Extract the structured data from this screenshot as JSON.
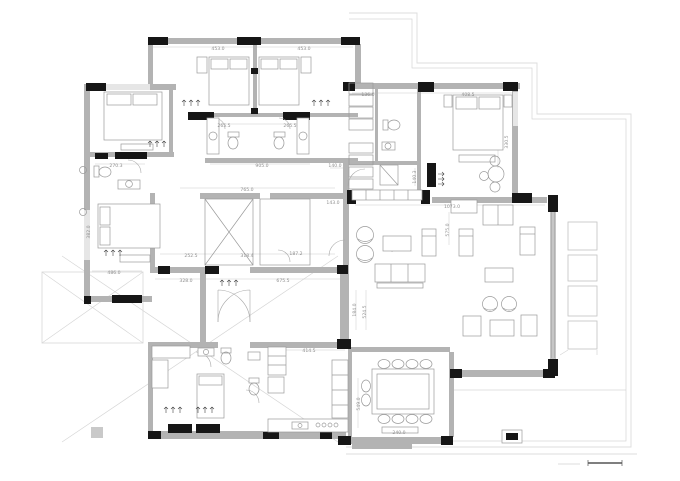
{
  "drawing": {
    "type": "architectural-floor-plan",
    "description": "Single-storey house plan with bedrooms, bathrooms, living room, dining room, kitchen, carport and terrace"
  },
  "colors": {
    "wall_gray": "#b3b3b3",
    "column_black": "#161616",
    "furniture_line": "#9a9a9a",
    "boundary_light": "#dcdcdc",
    "dimension_text": "#8f8f8f",
    "background": "#ffffff"
  },
  "symbols": [
    "double-bed-icon",
    "single-bed-icon",
    "toilet-icon",
    "sink-icon",
    "shower-icon",
    "dining-table-icon",
    "chair-icon",
    "sofa-icon",
    "armchair-icon",
    "coffee-table-icon",
    "kitchen-counter-icon",
    "wardrobe-icon",
    "stair-cross-icon",
    "door-swing-icon",
    "lounger-icon",
    "scale-bar-icon",
    "grid-marker-icon"
  ],
  "dims": [
    {
      "text": "453.0"
    },
    {
      "text": "453.0"
    },
    {
      "text": "136.0"
    },
    {
      "text": "408.5"
    },
    {
      "text": "265.5"
    },
    {
      "text": "265.5"
    },
    {
      "text": "905.0"
    },
    {
      "text": "765.0"
    },
    {
      "text": "140.0"
    },
    {
      "text": "143.0"
    },
    {
      "text": "140.3"
    },
    {
      "text": "270.3"
    },
    {
      "text": "382.0"
    },
    {
      "text": "328.0"
    },
    {
      "text": "675.5"
    },
    {
      "text": "252.5"
    },
    {
      "text": "318.4"
    },
    {
      "text": "187.2"
    },
    {
      "text": "486.0"
    },
    {
      "text": "414.5"
    },
    {
      "text": "1073.0"
    },
    {
      "text": "549.0"
    },
    {
      "text": "184.0"
    },
    {
      "text": "524.5"
    },
    {
      "text": "330.5"
    },
    {
      "text": "575.0"
    },
    {
      "text": "240.0"
    }
  ]
}
